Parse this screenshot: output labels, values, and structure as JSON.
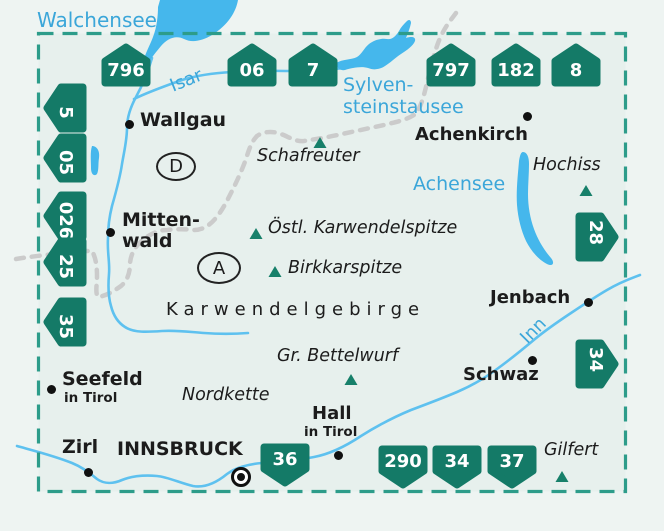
{
  "map_title": "Karwendelgebirge overview map",
  "badges": {
    "top": [
      "796",
      "06",
      "7",
      "797",
      "182",
      "8"
    ],
    "left": [
      "5",
      "05",
      "026",
      "25",
      "35"
    ],
    "right": [
      "28",
      "34"
    ],
    "bottom": [
      "36",
      "290",
      "34",
      "37"
    ]
  },
  "towns": {
    "wallgau": "Wallgau",
    "mittenwald_line1": "Mitten-",
    "mittenwald_line2": "wald",
    "achenkirch": "Achenkirch",
    "jenbach": "Jenbach",
    "schwaz": "Schwaz",
    "seefeld_line1": "Seefeld",
    "seefeld_line2": "in Tirol",
    "zirl": "Zirl",
    "innsbruck": "INNSBRUCK",
    "hall_line1": "Hall",
    "hall_line2": "in Tirol"
  },
  "peaks": {
    "schafreuter": "Schafreuter",
    "oestl_karwendelspitze": "Östl. Karwendelspitze",
    "birkkarspitze": "Birkkarspitze",
    "gr_bettelwurf": "Gr. Bettelwurf",
    "hochiss": "Hochiss",
    "gilfert": "Gilfert",
    "nordkette": "Nordkette"
  },
  "range_label": "Karwendelgebirge",
  "waters": {
    "walchensee": "Walchensee",
    "isar": "Isar",
    "sylvenstein_line1": "Sylven-",
    "sylvenstein_line2": "steinstausee",
    "achensee": "Achensee",
    "inn": "Inn"
  },
  "countries": {
    "germany": "D",
    "austria": "A"
  },
  "colors": {
    "badge_green": "#147a67",
    "border_teal": "#2d9c8a",
    "water_fill": "#45b7ec",
    "water_label_blue": "#3ba6d9",
    "country_border_gray": "#cbcbcb",
    "map_background": "#e7f0ed"
  }
}
